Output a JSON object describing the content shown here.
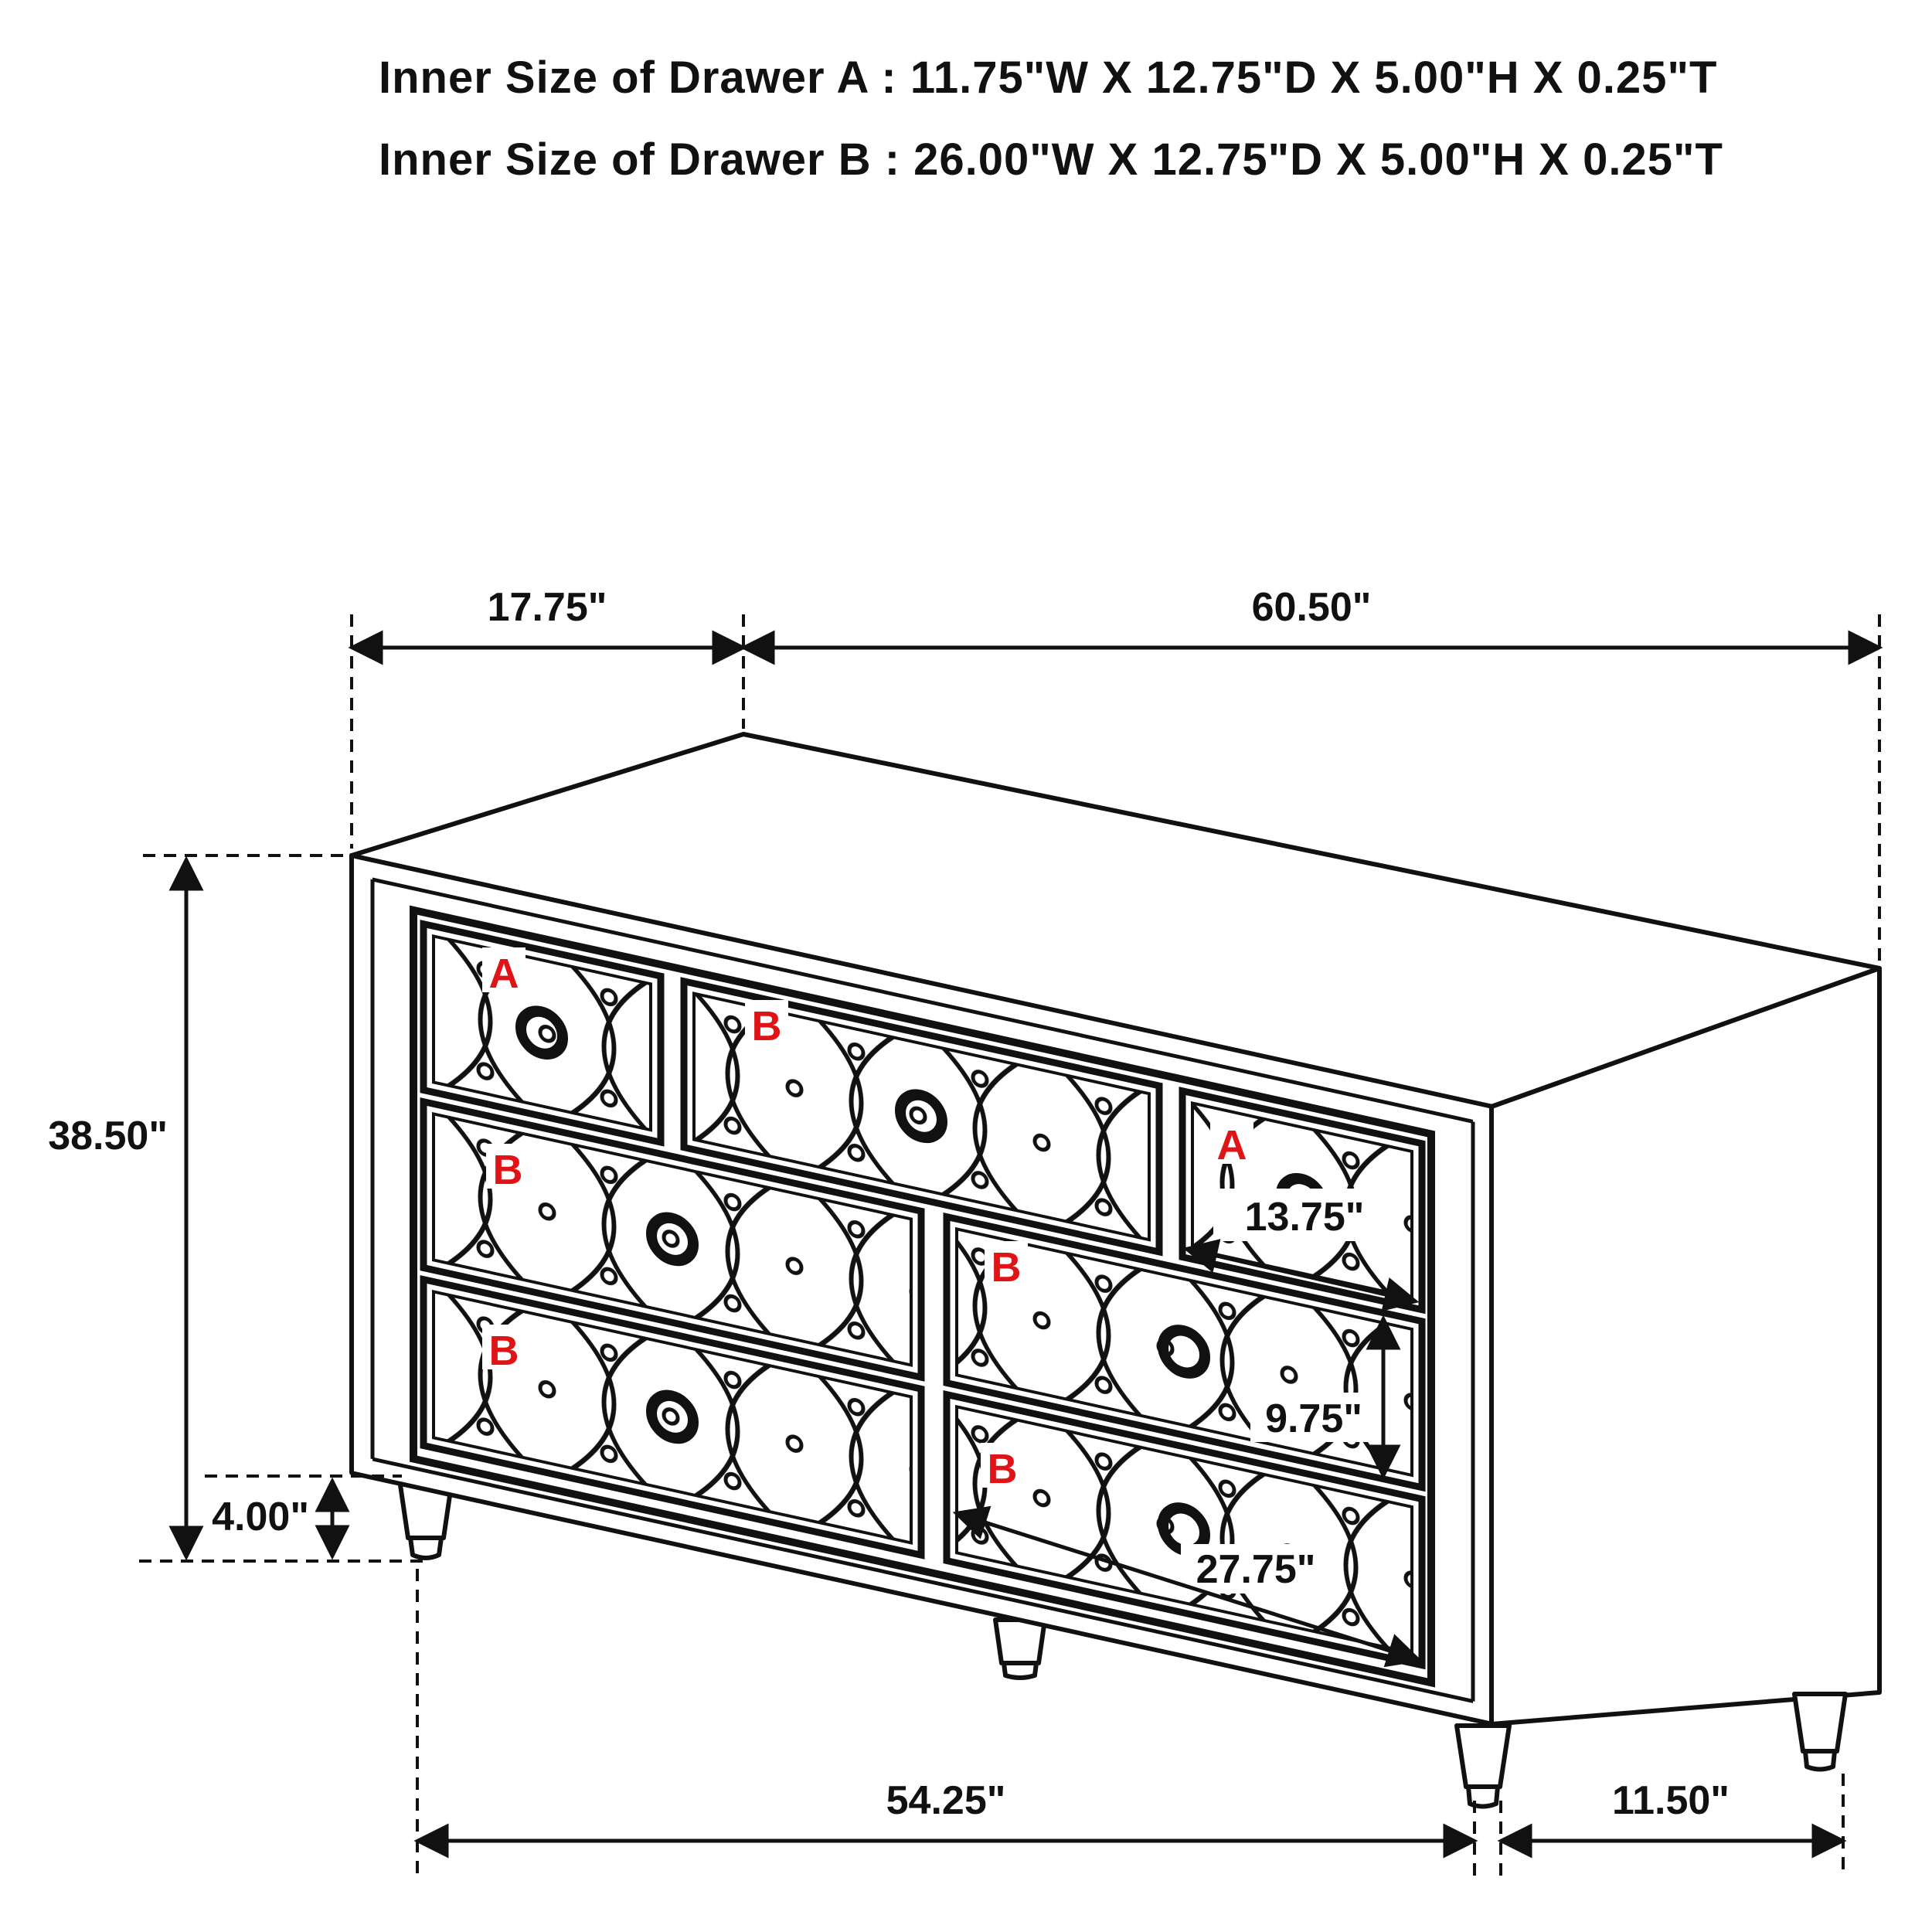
{
  "header": {
    "line_a": "Inner Size of Drawer A : 11.75\"W X 12.75\"D X 5.00\"H X 0.25\"T",
    "line_b": "Inner Size of Drawer B : 26.00\"W X 12.75\"D X 5.00\"H X 0.25\"T"
  },
  "dims": {
    "top_left_width": "17.75\"",
    "top_width": "60.50\"",
    "total_height": "38.50\"",
    "leg_height": "4.00\"",
    "drawer_a_width": "13.75\"",
    "drawer_b_height": "9.75\"",
    "drawer_b_width": "27.75\"",
    "base_width": "54.25\"",
    "side_depth": "11.50\""
  },
  "drawers": {
    "a1": {
      "label": "A"
    },
    "b1": {
      "label": "B"
    },
    "a2": {
      "label": "A"
    },
    "b3": {
      "label": "B"
    },
    "b4": {
      "label": "B"
    },
    "b5": {
      "label": "B"
    },
    "b6": {
      "label": "B"
    }
  },
  "colors": {
    "line": "#111111",
    "label_red": "#e01417",
    "background": "#ffffff"
  }
}
